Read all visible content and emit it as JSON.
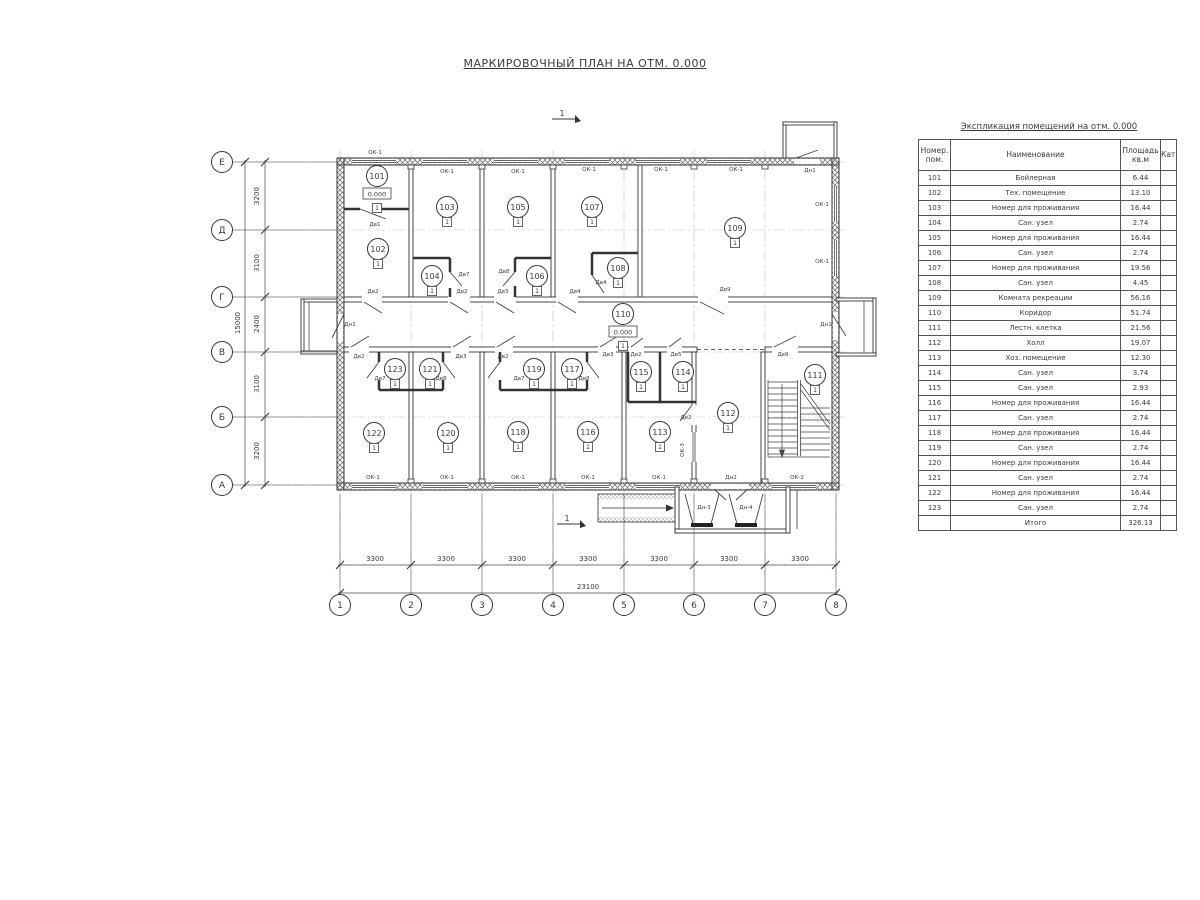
{
  "title": "МАРКИРОВОЧНЫЙ ПЛАН НА ОТМ. 0.000",
  "section_marks": [
    {
      "label": "1",
      "x": 566,
      "y": 112
    },
    {
      "label": "1",
      "x": 571,
      "y": 517
    }
  ],
  "axes": {
    "rows": [
      {
        "label": "Е",
        "y": 162
      },
      {
        "label": "Д",
        "y": 230
      },
      {
        "label": "Г",
        "y": 297
      },
      {
        "label": "В",
        "y": 352
      },
      {
        "label": "Б",
        "y": 417
      },
      {
        "label": "А",
        "y": 485
      }
    ],
    "cols": [
      {
        "label": "1",
        "x": 340
      },
      {
        "label": "2",
        "x": 411
      },
      {
        "label": "3",
        "x": 482
      },
      {
        "label": "4",
        "x": 553
      },
      {
        "label": "5",
        "x": 624
      },
      {
        "label": "6",
        "x": 694
      },
      {
        "label": "7",
        "x": 765
      },
      {
        "label": "8",
        "x": 836
      }
    ]
  },
  "dimensions": {
    "left_segments": [
      {
        "label": "3200",
        "y": 196
      },
      {
        "label": "3100",
        "y": 263
      },
      {
        "label": "2400",
        "y": 324
      },
      {
        "label": "3100",
        "y": 384
      },
      {
        "label": "3200",
        "y": 451
      }
    ],
    "left_total": {
      "label": "15000",
      "y": 323
    },
    "bottom_segments": [
      {
        "label": "3300",
        "x": 375
      },
      {
        "label": "3300",
        "x": 446
      },
      {
        "label": "3300",
        "x": 517
      },
      {
        "label": "3300",
        "x": 588
      },
      {
        "label": "3300",
        "x": 659
      },
      {
        "label": "3300",
        "x": 729
      },
      {
        "label": "3300",
        "x": 800
      }
    ],
    "bottom_total": {
      "label": "23100",
      "x": 588
    }
  },
  "floor_mark": "1",
  "rooms": [
    {
      "n": "101",
      "x": 377,
      "y": 176,
      "level": "0.000"
    },
    {
      "n": "102",
      "x": 378,
      "y": 249
    },
    {
      "n": "103",
      "x": 447,
      "y": 207
    },
    {
      "n": "104",
      "x": 432,
      "y": 276
    },
    {
      "n": "105",
      "x": 518,
      "y": 207
    },
    {
      "n": "106",
      "x": 537,
      "y": 276
    },
    {
      "n": "107",
      "x": 592,
      "y": 207
    },
    {
      "n": "108",
      "x": 618,
      "y": 268
    },
    {
      "n": "109",
      "x": 735,
      "y": 228
    },
    {
      "n": "110",
      "x": 623,
      "y": 314,
      "level": "0.000"
    },
    {
      "n": "111",
      "x": 815,
      "y": 375
    },
    {
      "n": "112",
      "x": 728,
      "y": 413
    },
    {
      "n": "113",
      "x": 660,
      "y": 432
    },
    {
      "n": "114",
      "x": 683,
      "y": 372
    },
    {
      "n": "115",
      "x": 641,
      "y": 372
    },
    {
      "n": "116",
      "x": 588,
      "y": 432
    },
    {
      "n": "117",
      "x": 572,
      "y": 369
    },
    {
      "n": "118",
      "x": 518,
      "y": 432
    },
    {
      "n": "119",
      "x": 534,
      "y": 369
    },
    {
      "n": "120",
      "x": 448,
      "y": 433
    },
    {
      "n": "121",
      "x": 430,
      "y": 369
    },
    {
      "n": "122",
      "x": 374,
      "y": 433
    },
    {
      "n": "123",
      "x": 395,
      "y": 369
    }
  ],
  "door_labels": [
    {
      "t": "Дн1",
      "x": 810,
      "y": 172
    },
    {
      "t": "Дв1",
      "x": 375,
      "y": 226
    },
    {
      "t": "Дв2",
      "x": 373,
      "y": 293
    },
    {
      "t": "Дв2",
      "x": 462,
      "y": 293
    },
    {
      "t": "Дв3",
      "x": 503,
      "y": 293
    },
    {
      "t": "Дв4",
      "x": 575,
      "y": 293
    },
    {
      "t": "Дв9",
      "x": 725,
      "y": 291
    },
    {
      "t": "Дв7",
      "x": 464,
      "y": 276
    },
    {
      "t": "Дв8",
      "x": 504,
      "y": 273
    },
    {
      "t": "Дв4",
      "x": 601,
      "y": 284
    },
    {
      "t": "Дн1",
      "x": 350,
      "y": 326
    },
    {
      "t": "Дн1",
      "x": 826,
      "y": 326
    },
    {
      "t": "Дв2",
      "x": 359,
      "y": 358
    },
    {
      "t": "Дв3",
      "x": 461,
      "y": 358
    },
    {
      "t": "Дв2",
      "x": 503,
      "y": 358
    },
    {
      "t": "Дв3",
      "x": 608,
      "y": 356
    },
    {
      "t": "Дв2",
      "x": 636,
      "y": 356
    },
    {
      "t": "Дв5",
      "x": 676,
      "y": 356
    },
    {
      "t": "Дв9",
      "x": 783,
      "y": 356
    },
    {
      "t": "Дв7",
      "x": 380,
      "y": 380
    },
    {
      "t": "Дв8",
      "x": 441,
      "y": 380
    },
    {
      "t": "Дв7",
      "x": 519,
      "y": 380
    },
    {
      "t": "Дв8",
      "x": 584,
      "y": 380
    },
    {
      "t": "Дв2",
      "x": 686,
      "y": 419
    },
    {
      "t": "Дн2",
      "x": 731,
      "y": 479
    },
    {
      "t": "Дн-3",
      "x": 704,
      "y": 509
    },
    {
      "t": "Дн-4",
      "x": 746,
      "y": 509
    }
  ],
  "window_labels": [
    {
      "t": "ОК-1",
      "x": 375,
      "y": 154
    },
    {
      "t": "ОК-1",
      "x": 447,
      "y": 173
    },
    {
      "t": "ОК-1",
      "x": 518,
      "y": 173
    },
    {
      "t": "ОК-1",
      "x": 589,
      "y": 171
    },
    {
      "t": "ОК-1",
      "x": 661,
      "y": 171
    },
    {
      "t": "ОК-1",
      "x": 736,
      "y": 171
    },
    {
      "t": "ОК-1",
      "x": 822,
      "y": 206
    },
    {
      "t": "ОК-1",
      "x": 822,
      "y": 263
    },
    {
      "t": "ОК-1",
      "x": 373,
      "y": 479
    },
    {
      "t": "ОК-1",
      "x": 447,
      "y": 479
    },
    {
      "t": "ОК-1",
      "x": 518,
      "y": 479
    },
    {
      "t": "ОК-1",
      "x": 588,
      "y": 479
    },
    {
      "t": "ОК-1",
      "x": 659,
      "y": 479
    },
    {
      "t": "ОК-2",
      "x": 797,
      "y": 479
    },
    {
      "t": "ОК-3",
      "x": 684,
      "y": 450,
      "vert": true
    }
  ],
  "table": {
    "title": "Экспликация помещений на отм. 0.000",
    "headers": {
      "num1": "Номер.",
      "num2": "пом.",
      "name": "Наименование",
      "area1": "Площадь",
      "area2": "кв.м",
      "cat": "Кат."
    },
    "rows": [
      [
        "101",
        "Бойлерная",
        "6.44"
      ],
      [
        "102",
        "Тех. помещение",
        "13.10"
      ],
      [
        "103",
        "Номер для проживания",
        "16.44"
      ],
      [
        "104",
        "Сан. узел",
        "2.74"
      ],
      [
        "105",
        "Номер для проживания",
        "16.44"
      ],
      [
        "106",
        "Сан. узел",
        "2.74"
      ],
      [
        "107",
        "Номер для проживания",
        "19.56"
      ],
      [
        "108",
        "Сан. узел",
        "4.45"
      ],
      [
        "109",
        "Комната рекреации",
        "56.16"
      ],
      [
        "110",
        "Коридор",
        "51.74"
      ],
      [
        "111",
        "Лестн. клетка",
        "21.56"
      ],
      [
        "112",
        "Холл",
        "19.07"
      ],
      [
        "113",
        "Хоз. помещение",
        "12.30"
      ],
      [
        "114",
        "Сан. узел",
        "3.74"
      ],
      [
        "115",
        "Сан. узел",
        "2.93"
      ],
      [
        "116",
        "Номер для проживания",
        "16.44"
      ],
      [
        "117",
        "Сан. узел",
        "2.74"
      ],
      [
        "118",
        "Номер для проживания",
        "16.44"
      ],
      [
        "119",
        "Сан. узел",
        "2.74"
      ],
      [
        "120",
        "Номер для проживания",
        "16.44"
      ],
      [
        "121",
        "Сан. узел",
        "2.74"
      ],
      [
        "122",
        "Номер для проживания",
        "16.44"
      ],
      [
        "123",
        "Сан. узел",
        "2.74"
      ]
    ],
    "total_label": "Итого",
    "total_value": "326.13"
  }
}
